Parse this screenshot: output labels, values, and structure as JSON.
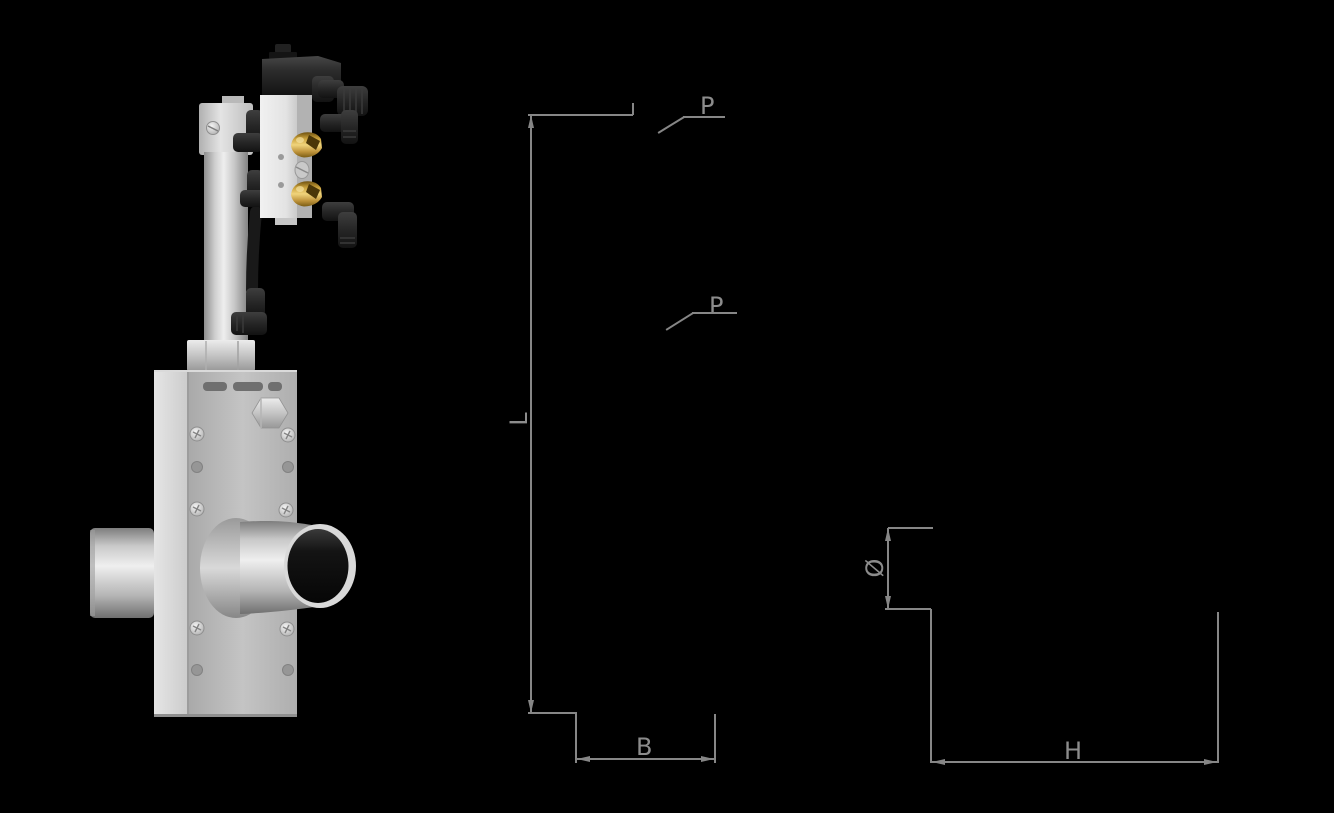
{
  "figure": {
    "kind": "technical dimension drawing with 3D product render",
    "product_render": "pneumatic angle-seat / pinch valve with pilot solenoid valve, push-in fittings and through-tube"
  },
  "dimension_labels": {
    "length": "L",
    "port_top": "P",
    "port_bottom": "P",
    "width": "B",
    "diameter": "Ø",
    "height": "H"
  },
  "colors": {
    "background": "#000000",
    "dimension_line": "#868686",
    "dimension_text": "#8c8c8c",
    "metal_light": "#e8e8e8",
    "metal_mid": "#c0c0c0",
    "plastic_black": "#1c1c1c",
    "brass": "#d8b04a"
  }
}
